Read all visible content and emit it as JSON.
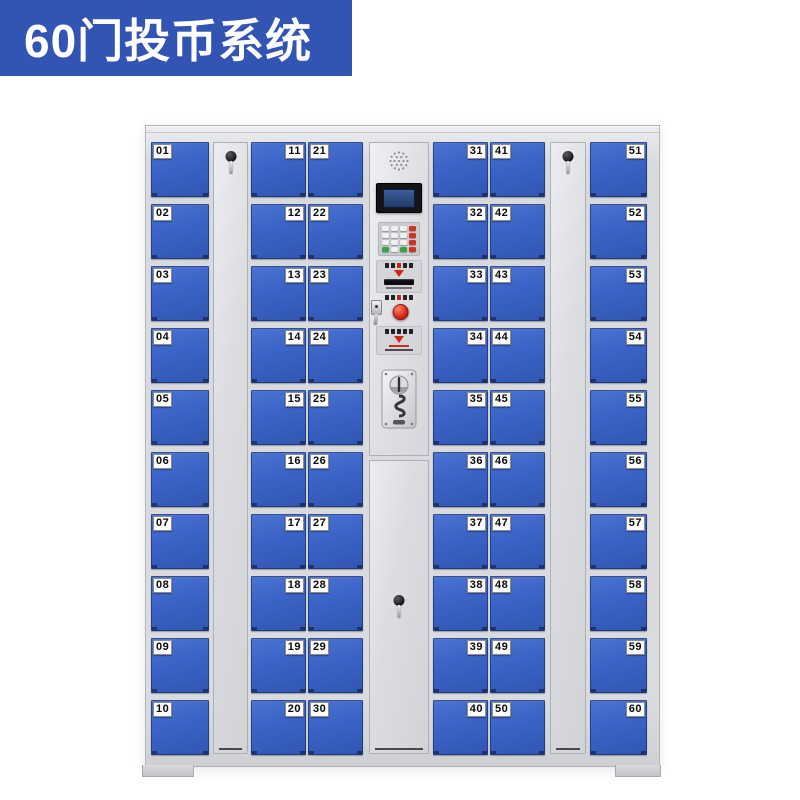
{
  "banner": {
    "title": "60门投币系统"
  },
  "colors": {
    "banner_bg": "#3254b2",
    "door_blue": "#3b62c4",
    "cabinet_gray": "#dadbdf",
    "accent_red": "#d42818",
    "keypad_green": "#36a44a",
    "label_bg": "#fbfbfb"
  },
  "cabinet": {
    "door_count_total": 60,
    "columns": [
      {
        "type": "doors",
        "label_side": "left",
        "numbers": [
          "01",
          "02",
          "03",
          "04",
          "05",
          "06",
          "07",
          "08",
          "09",
          "10"
        ]
      },
      {
        "type": "tall-door",
        "lock": "key-lock-with-key"
      },
      {
        "type": "doors",
        "label_side": "right",
        "numbers": [
          "11",
          "12",
          "13",
          "14",
          "15",
          "16",
          "17",
          "18",
          "19",
          "20"
        ]
      },
      {
        "type": "doors",
        "label_side": "left",
        "numbers": [
          "21",
          "22",
          "23",
          "24",
          "25",
          "26",
          "27",
          "28",
          "29",
          "30"
        ]
      },
      {
        "type": "control"
      },
      {
        "type": "doors",
        "label_side": "right",
        "numbers": [
          "31",
          "32",
          "33",
          "34",
          "35",
          "36",
          "37",
          "38",
          "39",
          "40"
        ]
      },
      {
        "type": "doors",
        "label_side": "left",
        "numbers": [
          "41",
          "42",
          "43",
          "44",
          "45",
          "46",
          "47",
          "48",
          "49",
          "50"
        ]
      },
      {
        "type": "tall-door",
        "lock": "key-lock-with-key"
      },
      {
        "type": "doors",
        "label_side": "right",
        "numbers": [
          "51",
          "52",
          "53",
          "54",
          "55",
          "56",
          "57",
          "58",
          "59",
          "60"
        ]
      }
    ]
  },
  "control_panel": {
    "elements": [
      "speaker-grille",
      "lcd-screen",
      "numeric-keypad",
      "card-slot-panel",
      "master-key-lock",
      "emergency-red-button",
      "instruction-panel",
      "coin-acceptor"
    ],
    "center_door_lock": "key-lock-with-key"
  }
}
